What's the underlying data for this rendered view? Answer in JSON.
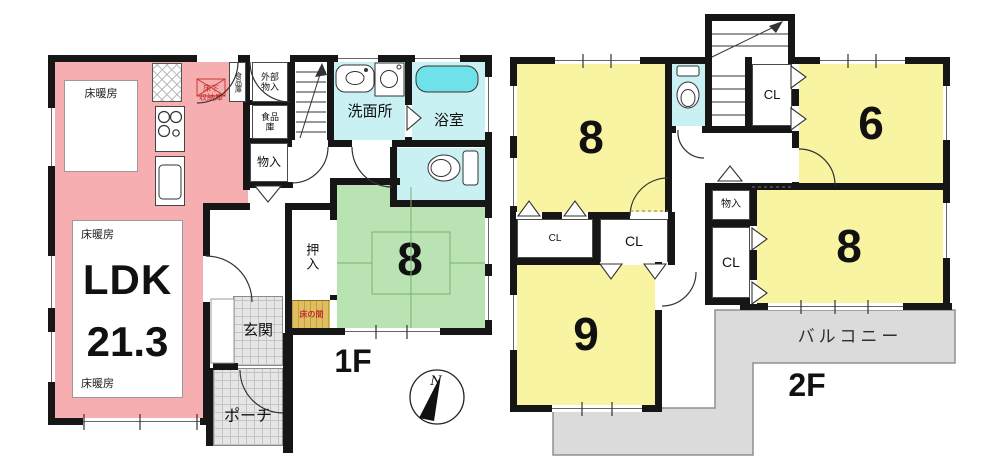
{
  "floor1": {
    "label": "1F",
    "compass_north": "N",
    "ldk": {
      "name": "LDK",
      "area": "21.3",
      "floor_heating": "床暖房"
    },
    "underfloor_storage": {
      "l1": "床下",
      "l2": "収納庫"
    },
    "pantry_narrow": "食品庫",
    "exterior_storage": {
      "l1": "外部",
      "l2": "物入"
    },
    "pantry": {
      "l1": "食品",
      "l2": "庫"
    },
    "storage": "物入",
    "washroom": "洗面所",
    "bathroom": "浴室",
    "tatami_size": "8",
    "oshiire": "押入",
    "tokonoma": "床の間",
    "entrance": "玄関",
    "porch": "ポーチ"
  },
  "floor2": {
    "label": "2F",
    "room_nw_size": "8",
    "room_ne_size": "6",
    "room_e_size": "8",
    "room_sw_size": "9",
    "closet": "CL",
    "storage": "物入",
    "balcony": "バルコニー"
  },
  "colors": {
    "ldk_pink": "#f7aeb0",
    "tatami_green": "#b9e3b2",
    "room_yellow": "#f9f4a1",
    "wet_cyan": "#c9f0f3",
    "bathtub_cyan": "#6fe2e9",
    "balcony_gray": "#dbdbdb",
    "tokonoma_tan": "#dfbe62",
    "wall_black": "#161616",
    "accent_red": "#c2302a"
  }
}
